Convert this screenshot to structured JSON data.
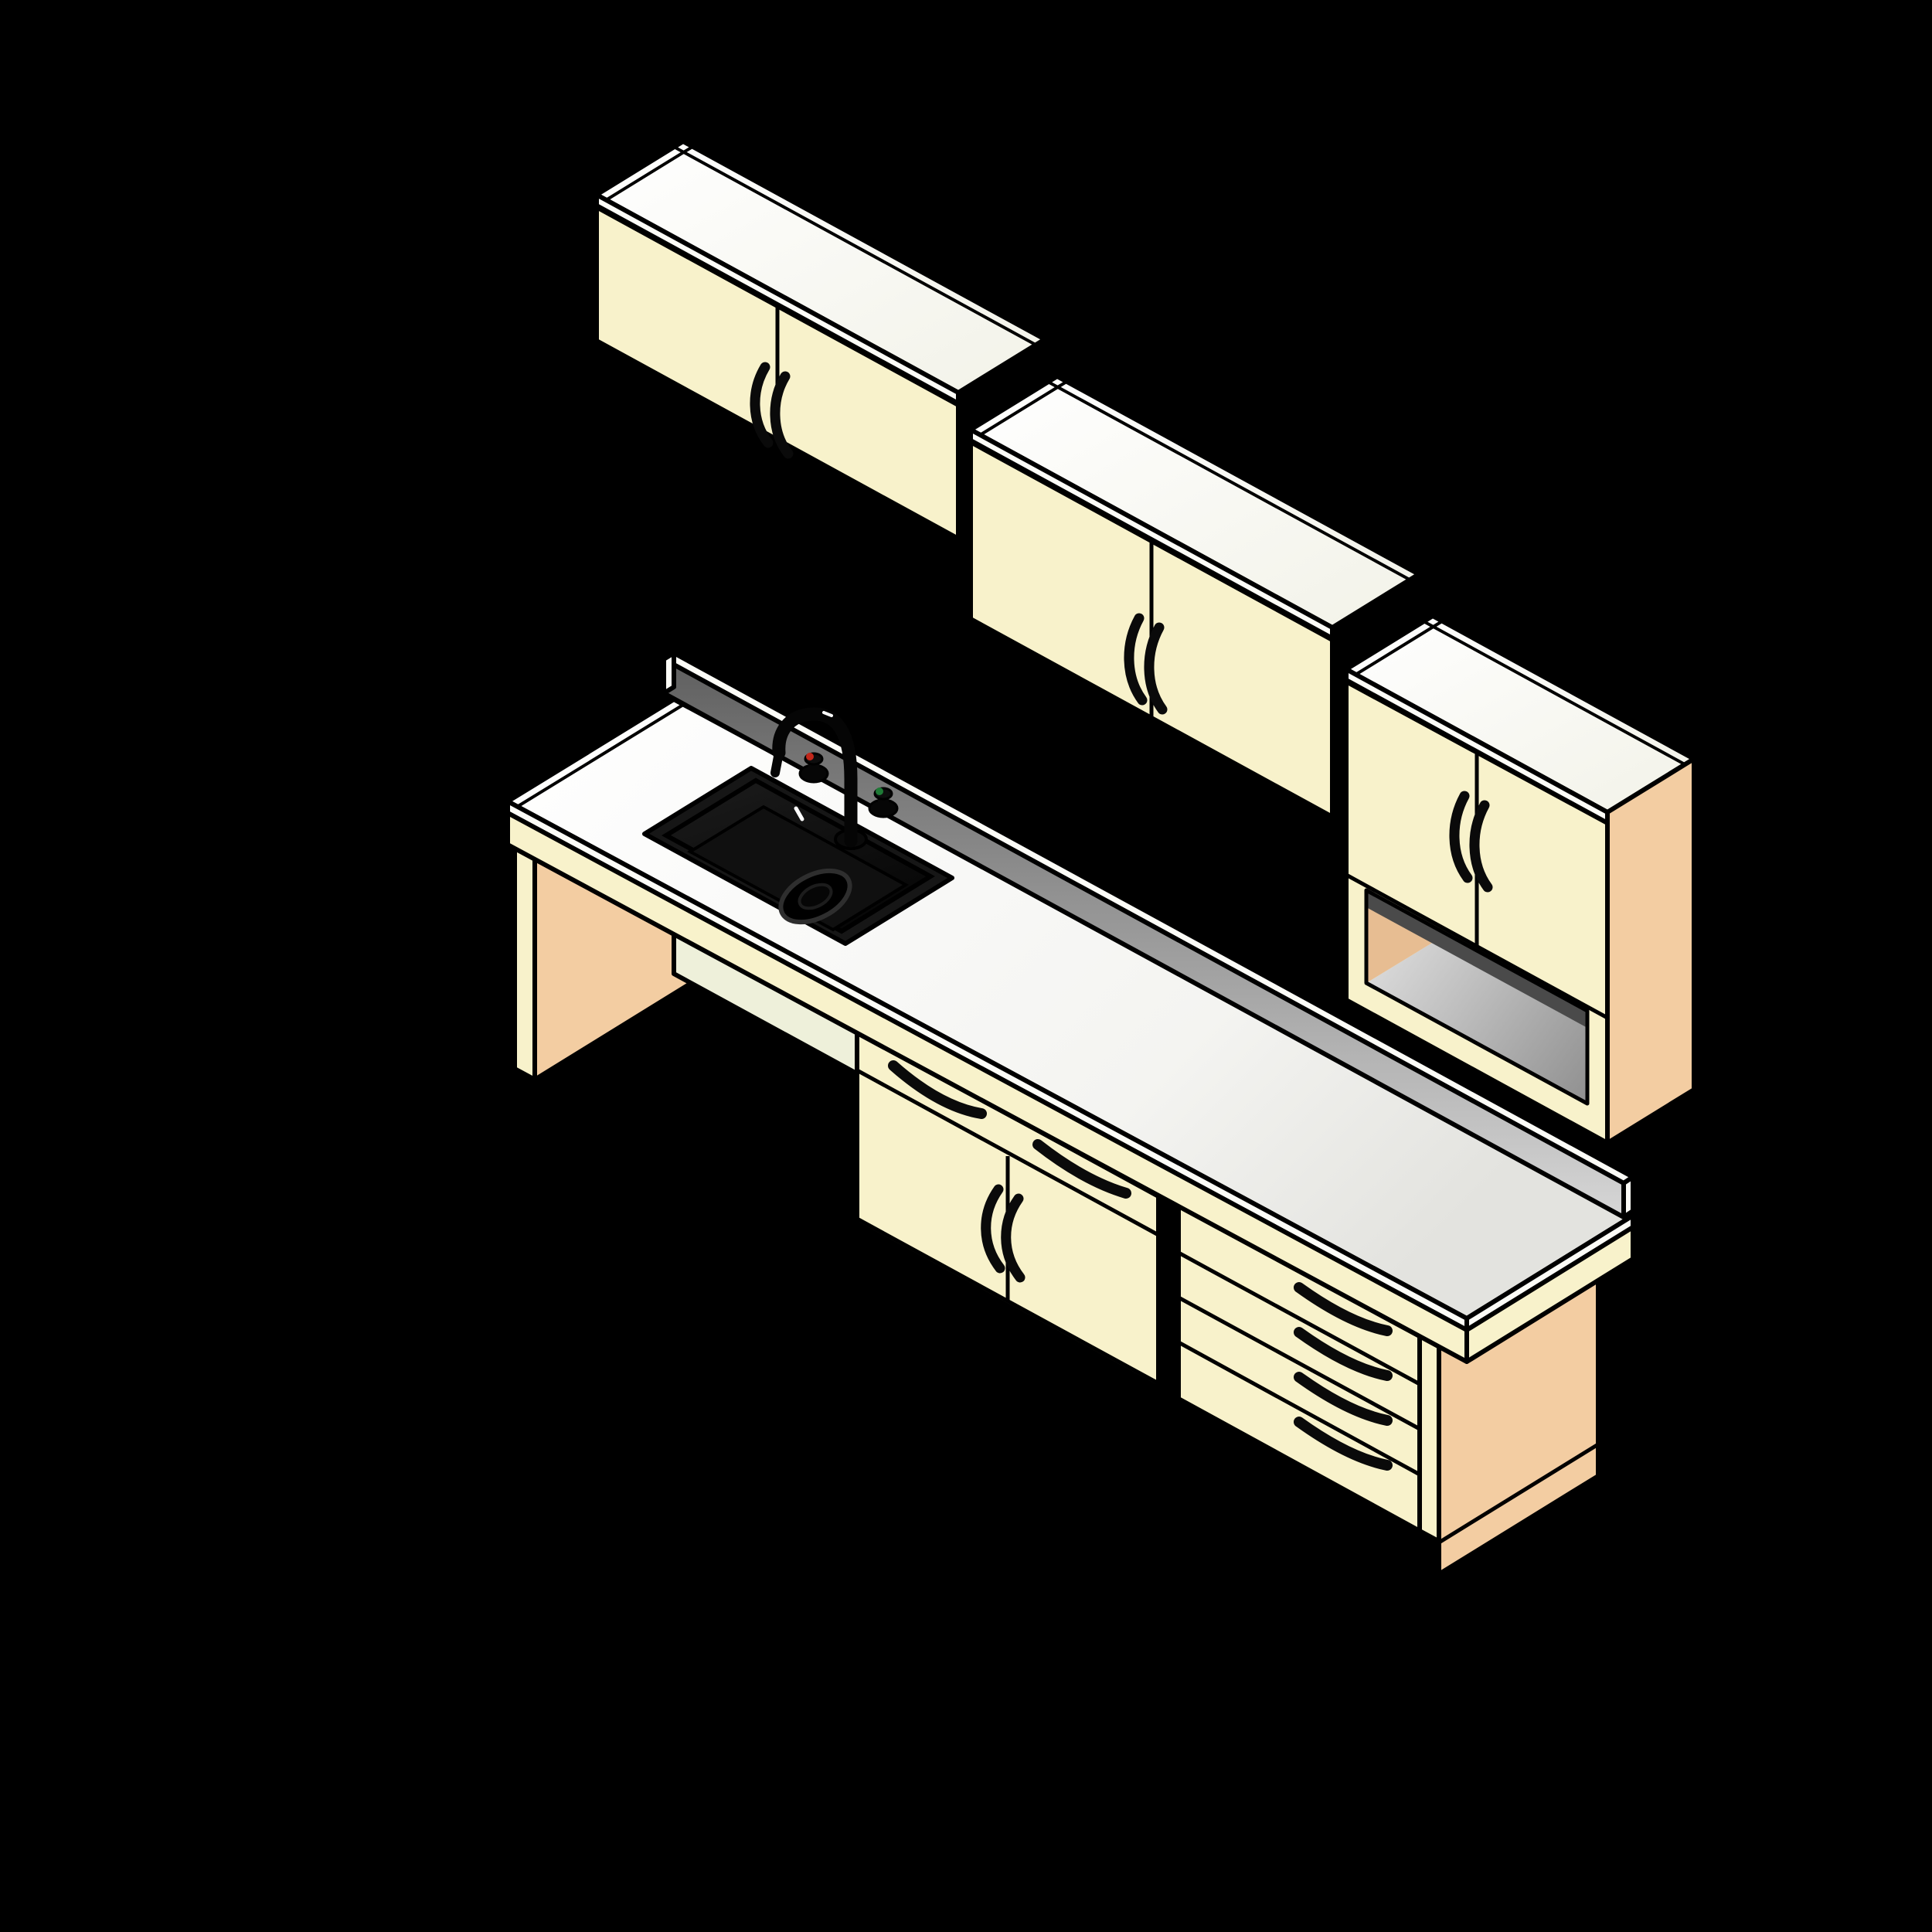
{
  "scene": {
    "type": "isometric-3d-rendering",
    "subject": "kitchen casework assembly: three wall cabinets, countertop with black sink and gooseneck faucet, knee-space support panel, base cabinet with drawers and doors, four-drawer base stack",
    "background": "#000000"
  },
  "palette": {
    "bg": "#000000",
    "outline": "#000000",
    "cream": "#f8f2cb",
    "creamDeep": "#f5edbd",
    "topWhite": "#fbfbf4",
    "stripWhite": "#fcfcf7",
    "counterWhite": "#ffffff",
    "tan": "#f3cda2",
    "tanShade": "#e7bd92",
    "splashDark": "#5f5f5f",
    "splashLight": "#d6d6d6",
    "shelfLight": "#dedede",
    "shelfDark": "#8f8f8f",
    "innerShadow": "#4a4a4a",
    "sinkRim": "#161616",
    "sinkBowl": "#0c0c0c",
    "hardware": "#0a0a0a",
    "kneeRail": "#eef0da",
    "hotDot": "#c1271b",
    "coldDot": "#1f7a36",
    "glint": "#ffffff"
  },
  "components": {
    "wall_cabinets": [
      {
        "id": "wall-cabinet-left",
        "doors": 2,
        "handles": 2
      },
      {
        "id": "wall-cabinet-middle",
        "doors": 2,
        "handles": 2
      },
      {
        "id": "wall-cabinet-right",
        "doors": 2,
        "handles": 2,
        "open_shelf": true,
        "end_panel": "tan"
      }
    ],
    "counter": {
      "top": "white laminate",
      "backsplash": true,
      "sink": "black drop-in single bowl with drain",
      "faucet": "black gooseneck with hot and cold knobs",
      "knee_space": true
    },
    "base_cabinets": [
      {
        "id": "support-end-panel-left",
        "type": "panel"
      },
      {
        "id": "base-cabinet-center",
        "drawers": 2,
        "doors": 2,
        "handles": 4
      },
      {
        "id": "base-drawer-stack",
        "drawers": 4,
        "handles": 4,
        "end_panel": "tan"
      }
    ]
  }
}
